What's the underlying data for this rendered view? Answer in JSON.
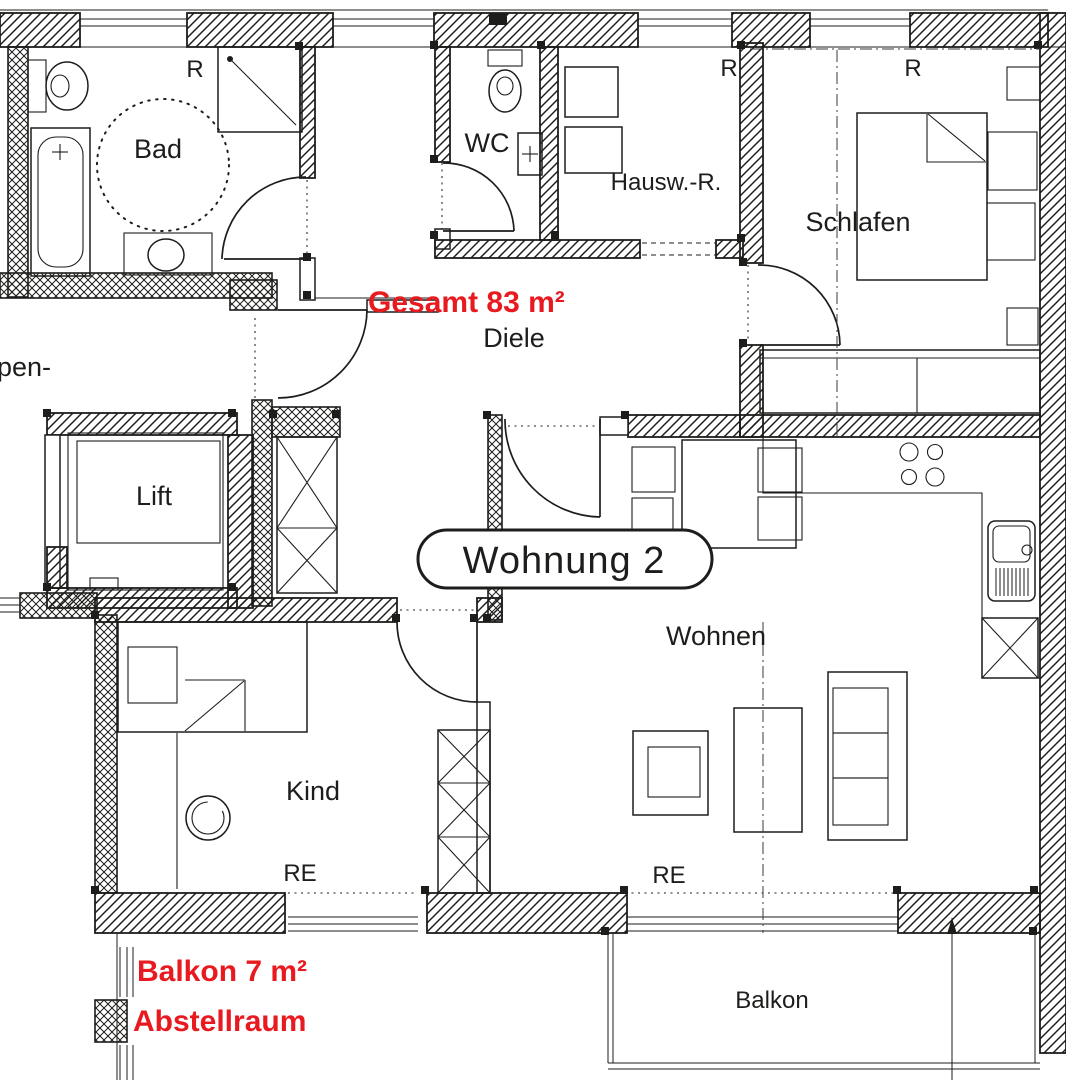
{
  "colors": {
    "ink": "#1d1d1b",
    "accent_red": "#e8191f",
    "background": "#ffffff"
  },
  "plan": {
    "apartment_label": "Wohnung  2",
    "total_area_label": "Gesamt 83 m²",
    "balcony_area_label": "Balkon 7 m²",
    "storage_label": "Abstellraum",
    "rooms": {
      "bad": "Bad",
      "wc": "WC",
      "hausw": "Hausw.-R.",
      "schlafen": "Schlafen",
      "diele": "Diele",
      "lift": "Lift",
      "wohnen": "Wohnen",
      "kind": "Kind",
      "balkon": "Balkon"
    },
    "markers": {
      "r_bad": "R",
      "r_hausw": "R",
      "r_schlafen": "R",
      "re_kind": "RE",
      "re_wohnen": "RE",
      "stair_fragment": "pen-"
    }
  }
}
